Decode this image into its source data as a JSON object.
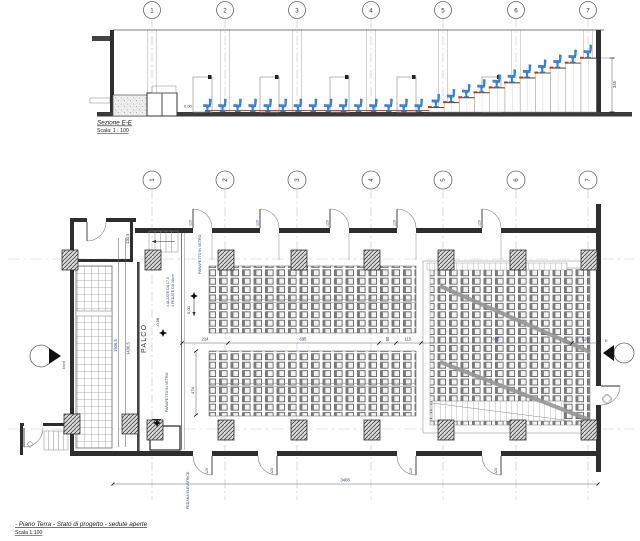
{
  "drawing": {
    "background": "#ffffff",
    "seat_color": "#3b88dd",
    "nosing_color": "#cf2d20"
  },
  "section": {
    "title": "Sezione E-E",
    "scale_label": "Scala: 1 : 100",
    "grid_bubbles": [
      "1",
      "2",
      "3",
      "4",
      "5",
      "6",
      "7"
    ],
    "floor_level": "0.00",
    "height_dim": "345"
  },
  "plan": {
    "title": "- Piano Terra - Stato di progetto - sedute aperte",
    "scale_label": "Scala 1:100",
    "grid_bubbles": [
      "1",
      "2",
      "3",
      "4",
      "5",
      "6",
      "7"
    ],
    "stage_label": "PALCO",
    "north_label": "Nord",
    "section_marker_label": "E",
    "notes": {
      "parapet_top": "PARAPETTO IN VETRO",
      "parapet_bottom": "PARAPETTO IN VETRO",
      "steps_line1": "4 ALZATE DA 17,5",
      "steps_line2": "4 PEDATE DA 30cm",
      "platform_lift": "PEDANA ELEVATRICE"
    },
    "levels": {
      "hall": "0,00",
      "stage": "-0,98"
    },
    "dims": {
      "aisle_segments": [
        "214",
        "695",
        "80",
        "115",
        "695",
        "120"
      ],
      "seat_block_depth": "474",
      "overall_width": "3408",
      "stage_side": [
        "130,5",
        "1506,5",
        "1436,5"
      ],
      "door_width": "120"
    }
  }
}
